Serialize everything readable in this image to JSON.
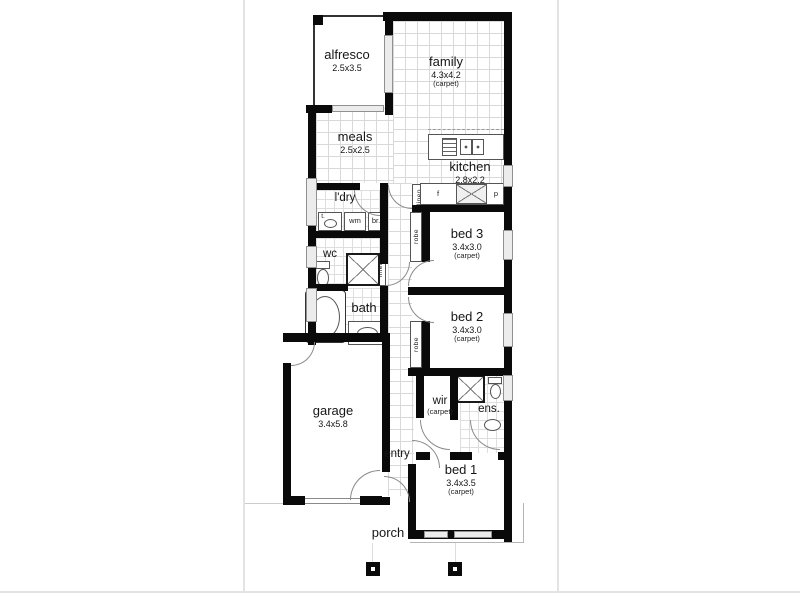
{
  "rooms": {
    "alfresco": {
      "name": "alfresco",
      "size": "2.5x3.5"
    },
    "family": {
      "name": "family",
      "size": "4.3x4.2",
      "note": "(carpet)"
    },
    "meals": {
      "name": "meals",
      "size": "2.5x2.5"
    },
    "kitchen": {
      "name": "kitchen",
      "size": "2.8x2.2"
    },
    "laundry": {
      "name": "l'dry"
    },
    "wc": {
      "name": "wc"
    },
    "bath": {
      "name": "bath"
    },
    "bed3": {
      "name": "bed 3",
      "size": "3.4x3.0",
      "note": "(carpet)"
    },
    "bed2": {
      "name": "bed 2",
      "size": "3.4x3.0",
      "note": "(carpet)"
    },
    "garage": {
      "name": "garage",
      "size": "3.4x5.8"
    },
    "entry": {
      "name": "entry"
    },
    "wir": {
      "name": "wir",
      "note": "(carpet)"
    },
    "ens": {
      "name": "ens."
    },
    "bed1": {
      "name": "bed 1",
      "size": "3.4x3.5",
      "note": "(carpet)"
    },
    "porch": {
      "name": "porch"
    }
  },
  "storage": {
    "linen_hall": "linen",
    "linen_bath": "linen",
    "robe_bed3": "robe",
    "robe_bed2": "robe"
  },
  "fixtures": {
    "trough": "t.",
    "washing_machine": "wm",
    "broom": "br.",
    "fridge": "f",
    "pantry": "p"
  },
  "icons": {
    "toilet-icon": "cistern-rect+bowl-ellipse",
    "bathtub-icon": "rounded-rect+inner-ellipse",
    "basin-icon": "ellipse",
    "shower-icon": "x-crossed-box",
    "cooktop-icon": "striped-box",
    "sink-icon": "double-bowl-box",
    "porch-post-icon": "black-square-white-center"
  },
  "colors": {
    "wall": "#0a0a0a",
    "window_fill": "#ececec",
    "window_edge": "#909090",
    "tile_line": "#d9d9d9",
    "door_arc": "#8a8a8a",
    "page_border": "#e3e3e3",
    "text": "#161616"
  }
}
